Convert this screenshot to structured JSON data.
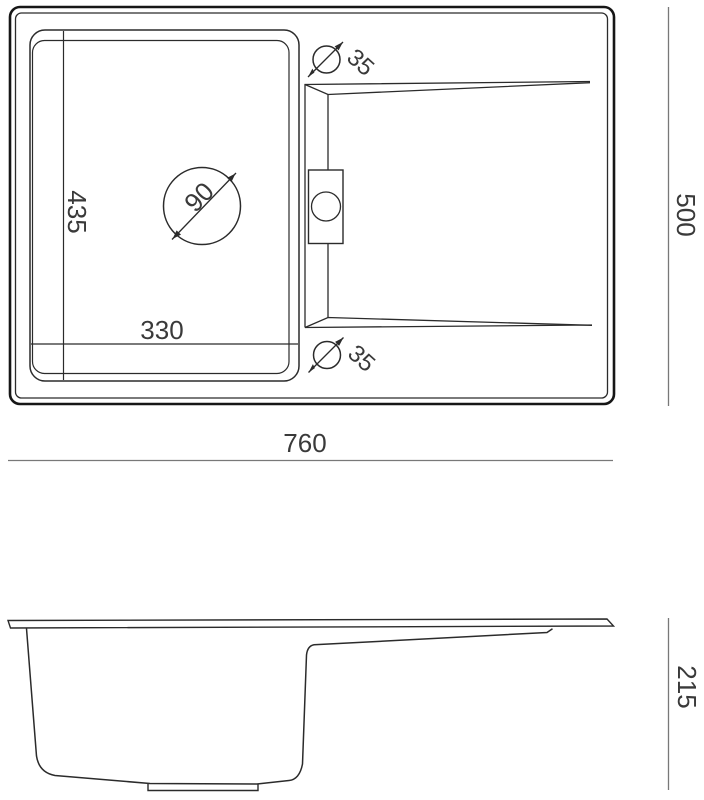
{
  "drawing": {
    "subject": "kitchen sink technical drawing",
    "background_color": "#ffffff",
    "line_color": "#2b2b2b",
    "dimension_line_color": "#787878",
    "text_color": "#3a3a3a",
    "views": {
      "top_view": {
        "name": "top view",
        "dimensions": {
          "overall_width": "760",
          "overall_depth": "500",
          "bowl_depth": "435",
          "bowl_width": "330",
          "drain_diameter": "90",
          "tap_hole_top_diameter": "35",
          "tap_hole_bottom_diameter": "35"
        }
      },
      "side_view": {
        "name": "side view",
        "dimensions": {
          "height": "215"
        }
      }
    }
  }
}
